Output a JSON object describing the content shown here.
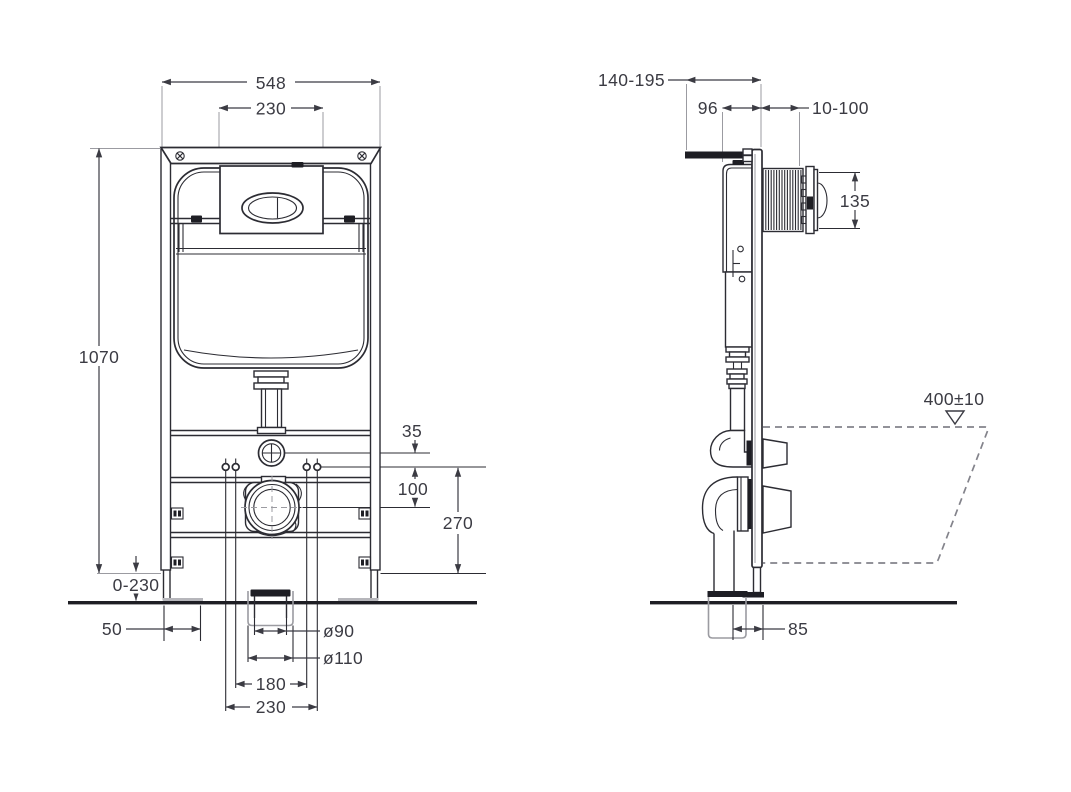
{
  "drawing_type": "technical installation diagram, concealed WC cistern frame, front and side elevation",
  "colors": {
    "line": "#2c2c33",
    "dimension_text": "#3b3b43",
    "extension_line": "#9b9ba1",
    "dashed_outline": "#83838b"
  },
  "front_view": {
    "dims": {
      "frame_width": "548",
      "flush_plate_width": "230",
      "frame_height": "1070",
      "leg_extension": "0-230",
      "foot_width": "50",
      "supply_offset": "35",
      "bolts_to_drain": "100",
      "drain_height": "270",
      "outlet_pipe_diameter": "ø90",
      "outlet_sleeve_diameter": "ø110",
      "fixing_bolts_inner": "180",
      "fixing_bolts_outer": "230"
    }
  },
  "side_view": {
    "dims": {
      "depth_adjust": "140-195",
      "cistern_depth": "96",
      "wall_finish_range": "10-100",
      "flush_plate_height": "135",
      "pan_outline_height": "400±10",
      "outlet_offset": "85"
    }
  }
}
